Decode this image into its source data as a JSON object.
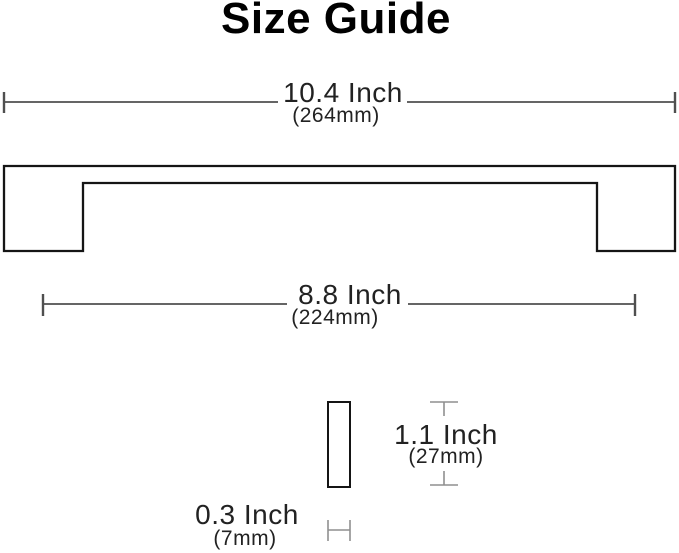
{
  "title": "Size Guide",
  "product": "handle-size-guide-diagram",
  "dimensions": {
    "overall_length": {
      "inch": "10.4 Inch",
      "mm": "(264mm)"
    },
    "hole_spacing": {
      "inch": "8.8 Inch",
      "mm": "(224mm)"
    },
    "height": {
      "inch": "1.1 Inch",
      "mm": "(27mm)"
    },
    "thickness": {
      "inch": "0.3 Inch",
      "mm": "(7mm)"
    }
  },
  "colors": {
    "background": "#ffffff",
    "title_text": "#000000",
    "label_text": "#222222",
    "dimension_line": "#4f4f4f",
    "indicator_line": "#8f8f8f",
    "outline": "#151515"
  }
}
